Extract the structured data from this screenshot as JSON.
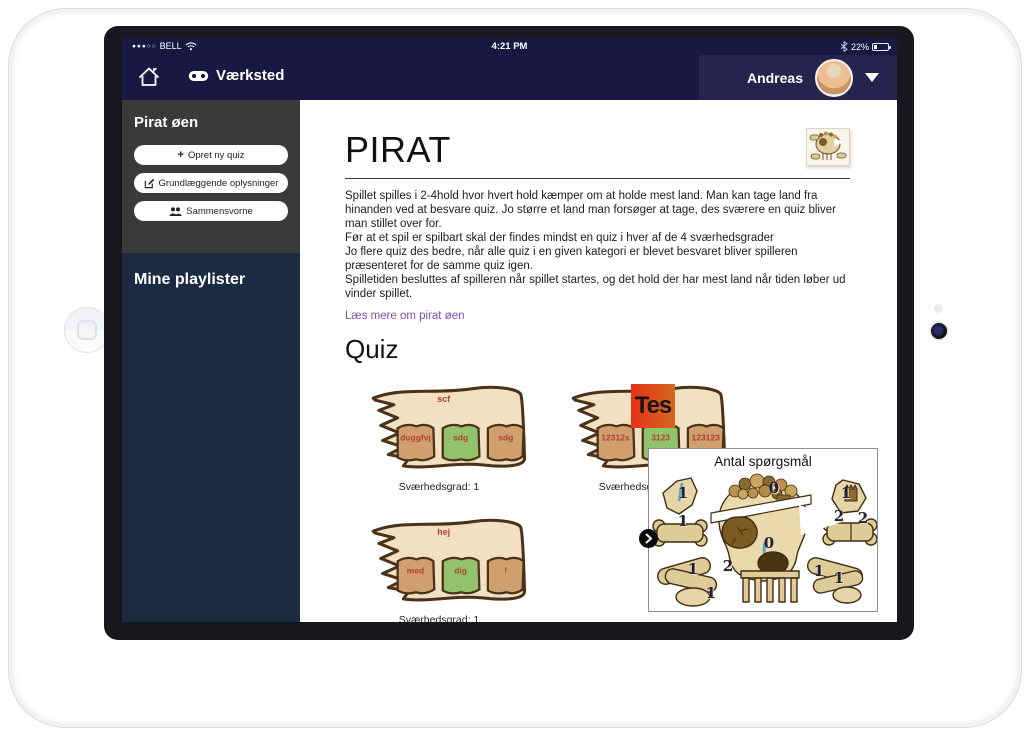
{
  "status_bar": {
    "signal_dots": "●●●○○",
    "carrier": "BELL",
    "wifi_icon": "wifi-icon",
    "time": "4:21 PM",
    "bluetooth_icon": "bluetooth-icon",
    "battery_percent": "22%"
  },
  "nav": {
    "home_icon": "house-icon",
    "brand_icon": "gamepad-icon",
    "brand": "Værksted",
    "user_name": "Andreas",
    "user_menu_icon": "chevron-down-icon"
  },
  "sidebar": {
    "title": "Pirat øen",
    "buttons": [
      {
        "icon": "plus-icon",
        "label": "Opret ny quiz"
      },
      {
        "icon": "pencil-square-icon",
        "label": "Grundlæggende oplysninger"
      },
      {
        "icon": "users-icon",
        "label": "Sammensvorne"
      }
    ],
    "playlists_title": "Mine playlister"
  },
  "content": {
    "title": "PIRAT",
    "title_thumb": "pirate-island-map-thumbnail",
    "paragraphs": [
      "Spillet spilles i 2-4hold hvor hvert hold kæmper om at holde mest land. Man kan tage land fra hinanden ved at besvare quiz. Jo større et land man forsøger at tage, des sværere en quiz bliver man stillet over for.",
      "Før at et spil er spilbart skal der findes mindst en quiz i hver af de 4 sværhedsgrader",
      "Jo flere quiz des bedre, når alle quiz i en given kategori er blevet besvaret bliver spilleren præsenteret for de samme quiz igen.",
      "Spilletiden besluttes af spilleren når spillet startes, og det hold der har mest land når tiden løber ud vinder spillet."
    ],
    "link": "Læs mere om pirat øen",
    "quiz_heading": "Quiz",
    "quizzes": [
      {
        "title": "scf",
        "books": [
          "duggfvj",
          "sdg",
          "sdg"
        ],
        "difficulty": "Sværhedsgrad: 1"
      },
      {
        "title": "",
        "logo": "Tes",
        "books": [
          "12312s",
          "3123",
          "123123"
        ],
        "difficulty": "Sværhedsgrad: 1"
      },
      {
        "title": "hej",
        "books": [
          "med",
          "dig",
          "!"
        ],
        "difficulty": "Sværhedsgrad: 1"
      }
    ]
  },
  "overlay": {
    "title": "Antal spørgsmål",
    "map": "skull-island-map",
    "nav_icon": "chevron-right-icon",
    "counts": [
      "1",
      "1",
      "0",
      "1",
      "2",
      "2",
      "0",
      "1",
      "2",
      "1",
      "1",
      "1"
    ]
  },
  "colors": {
    "navbar": "#181843",
    "navbar_user_area": "#24244d",
    "sidebar_top": "#3a3a3a",
    "sidebar_bottom": "#1c2b42",
    "link": "#7a4fb5",
    "parchment": "#f1e1c2",
    "parchment_outline": "#4a3118",
    "book_tan": "#cf9f6e",
    "book_green": "#93c26d",
    "book_label": "#b0432a",
    "logo_gradient_start": "#e63119",
    "logo_gradient_end": "#d2691e"
  }
}
